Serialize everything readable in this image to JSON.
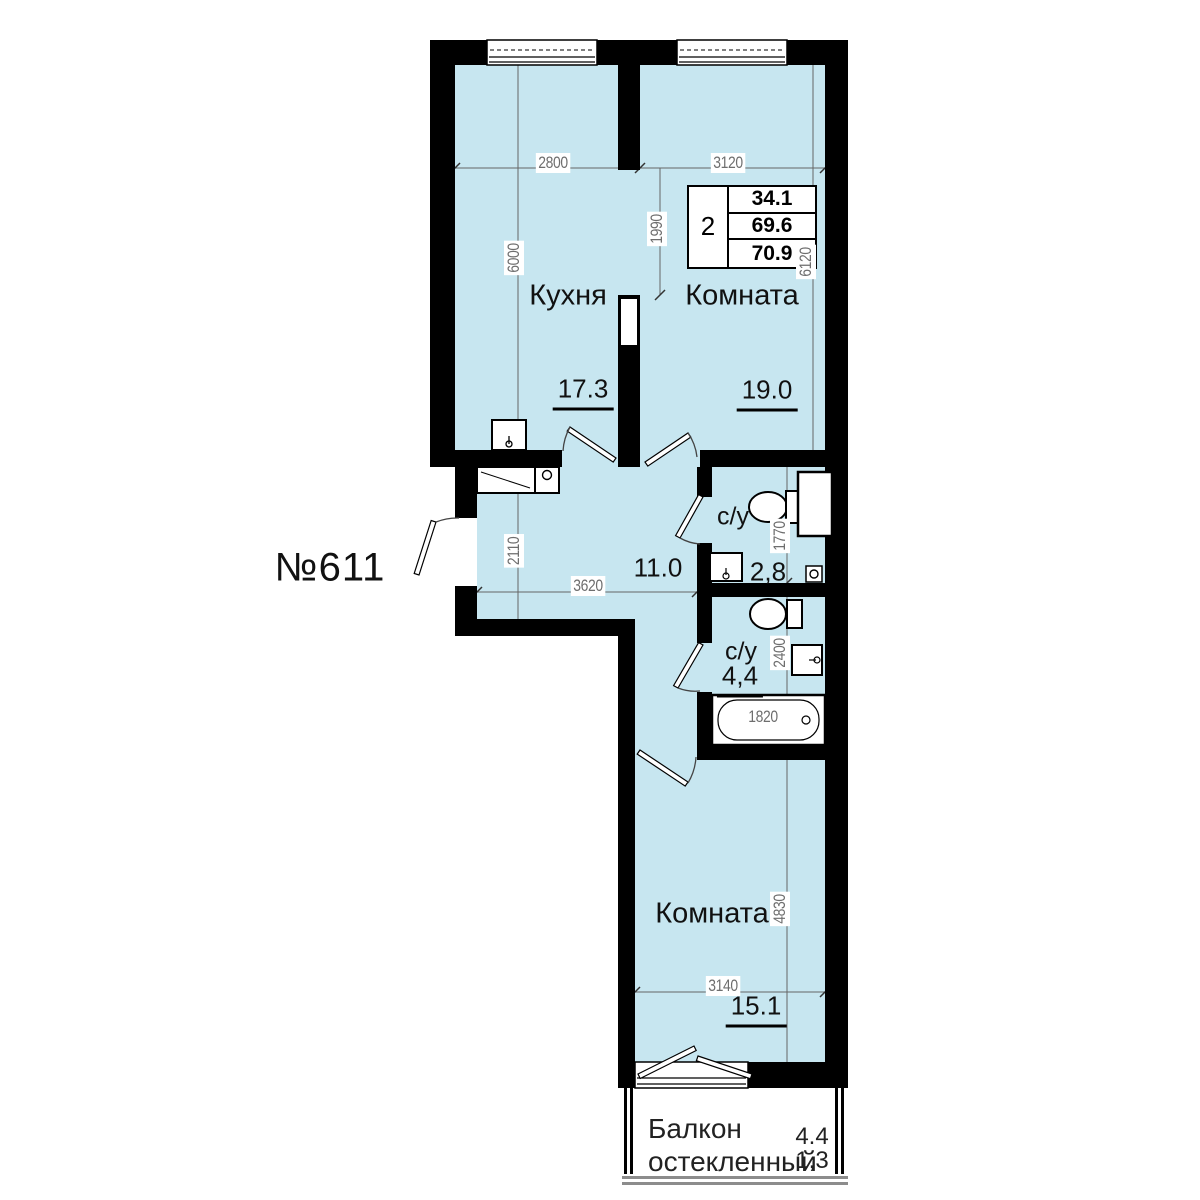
{
  "texts": {
    "apartment_number": "№611",
    "kitchen_label": "Кухня",
    "kitchen_area": "17.3",
    "room1_label": "Комната",
    "room1_area": "19.0",
    "hall_area": "11.0",
    "bath1_label": "с/у",
    "bath1_area": "2,8",
    "bath2_label": "с/у",
    "bath2_area": "4,4",
    "room2_label": "Комната",
    "room2_area": "15.1",
    "balcony_label_1": "Балкон",
    "balcony_label_2": "остекленный",
    "balcony_area_1": "4.4",
    "balcony_area_2": "1,3",
    "table_rooms": "2",
    "table_area_living": "34.1",
    "table_area_1": "69.6",
    "table_area_total": "70.9"
  },
  "dims": {
    "d2800": "2800",
    "d3120": "3120",
    "d1990": "1990",
    "d6000": "6000",
    "d6120": "6120",
    "d2110": "2110",
    "d3620": "3620",
    "d1770": "1770",
    "d2400": "2400",
    "d1820": "1820",
    "d4830": "4830",
    "d3140": "3140"
  },
  "colors": {
    "room_fill": "#c7e6f0",
    "wall": "#000000",
    "dim_text": "#6e6e6e"
  }
}
